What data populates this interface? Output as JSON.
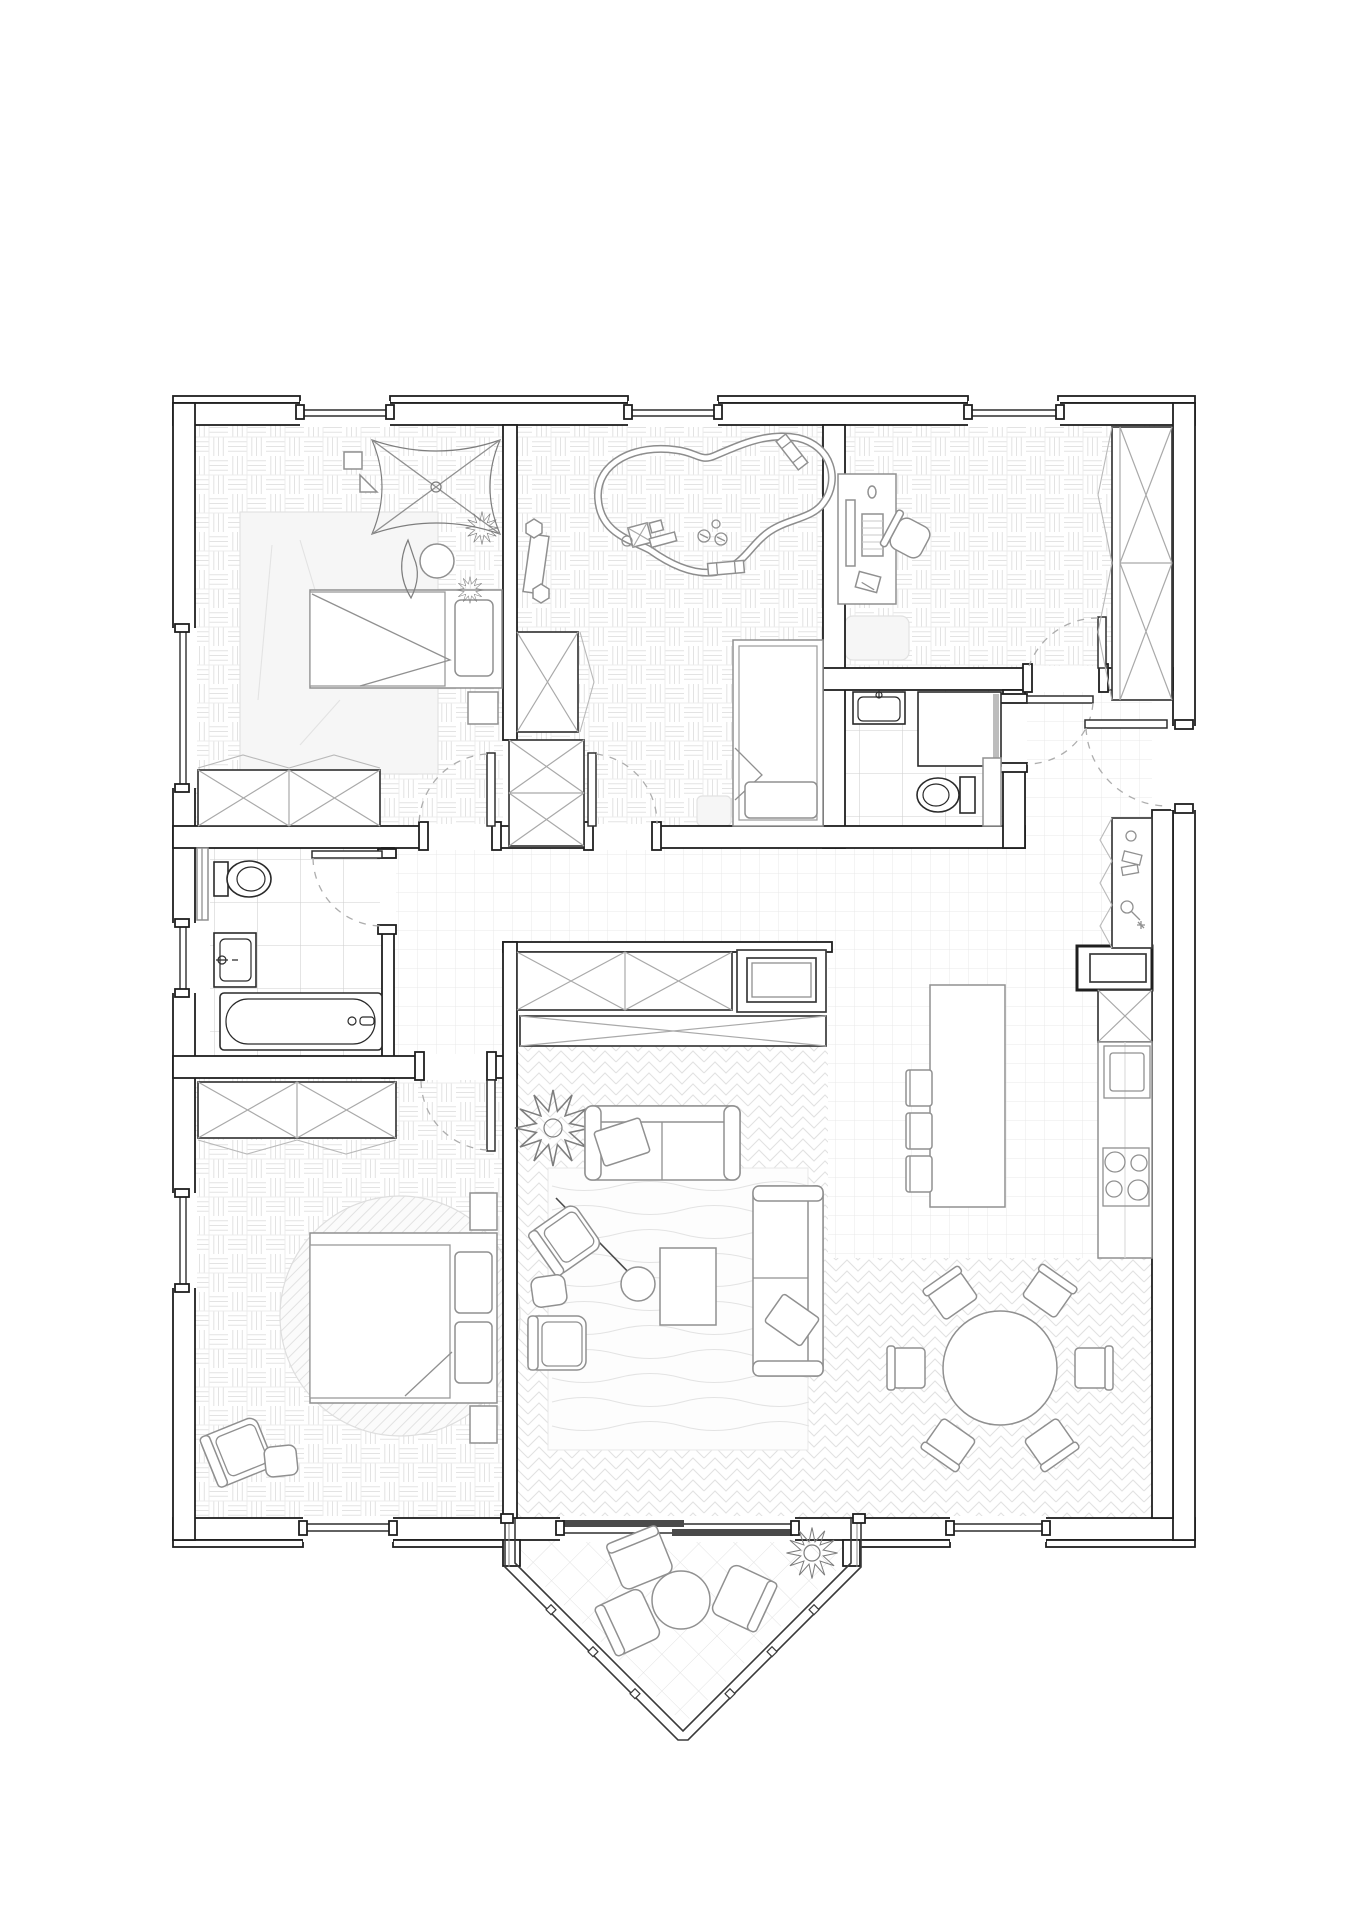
{
  "document": {
    "title": "Apartment floor plan — top view architectural drawing",
    "description": "Black and grey line drawing of a three-bedroom apartment with office, two bathrooms, open living-kitchen-dining space and a pointed balcony with outdoor seating.",
    "background_color": "#ffffff",
    "wall_line_color": "#1f1f1f",
    "furniture_line_color": "#909090",
    "floor_pattern_color": "#e3e3e3",
    "door_arc_style": "dashed grey quarter circles"
  },
  "rooms": [
    {
      "id": "bedroom-1",
      "location": "top-left",
      "floor": "basketweave parquet",
      "furniture": [
        "large light area rug",
        "single bed with pillow and folded duvet",
        "hanging play mobile with four fabric sails",
        "small wall frame",
        "triangle pennant",
        "round floor cushion",
        "leafy plants",
        "two-module X-front dresser",
        "bedside bench"
      ]
    },
    {
      "id": "kids-room",
      "location": "top-middle",
      "floor": "basketweave parquet",
      "furniture": [
        "toy train track loop with train, wheels and two bridges",
        "angled play bench with two hexagonal stools",
        "tall X-front wardrobe",
        "single bed with pillow",
        "small rug"
      ]
    },
    {
      "id": "office",
      "location": "top-right",
      "floor": "basketweave parquet",
      "furniture": [
        "desk with monitor, keyboard, mouse and notepad",
        "swivel office chair",
        "small rug",
        "full-height X-front wardrobe with swing marks"
      ]
    },
    {
      "id": "bathroom-small",
      "location": "middle-right",
      "floor": "large tile grid",
      "fixtures": [
        "washbasin with tap",
        "shower cabin with glass panel",
        "toilet with cistern",
        "tall slim cabinet"
      ]
    },
    {
      "id": "bathroom-main",
      "location": "middle-left",
      "floor": "large tile grid",
      "fixtures": [
        "wall radiator",
        "toilet with cistern",
        "washbasin with tap",
        "bathtub with faucet"
      ]
    },
    {
      "id": "hallway",
      "location": "center",
      "floor": "fine square tile grid",
      "furniture": []
    },
    {
      "id": "entry",
      "location": "right",
      "floor": "fine square tile grid",
      "furniture": [
        "entry door",
        "three-door wardrobe with swing marks",
        "mirror dot, shoe boxes and key hook glyphs"
      ]
    },
    {
      "id": "bedroom-2",
      "location": "bottom-left",
      "floor": "basketweave parquet",
      "furniture": [
        "two-module X-front closet",
        "double bed with two pillows and folded duvet",
        "two nightstands",
        "round hatched rug",
        "armchair with ottoman"
      ]
    },
    {
      "id": "living-room",
      "location": "bottom-center",
      "floor": "herringbone parquet",
      "furniture": [
        "X-front sideboard",
        "TV unit with television",
        "long low X-front console",
        "spiky potted plant",
        "three-seat sofa with cushion",
        "chaise sofa with cushion",
        "rectangular coffee table",
        "arc floor lamp",
        "two armchairs",
        "ottoman",
        "large wavy-striped rug"
      ]
    },
    {
      "id": "kitchen",
      "location": "right",
      "floor": "fine square tile grid",
      "furniture": [
        "refrigerator box",
        "tall X-front cabinet",
        "counter with sink",
        "cooktop with four burners",
        "kitchen island",
        "three bar stools"
      ]
    },
    {
      "id": "dining",
      "location": "bottom-right",
      "floor": "herringbone parquet",
      "furniture": [
        "round dining table",
        "six chairs"
      ]
    },
    {
      "id": "balcony",
      "location": "bottom, pointed pentagon",
      "floor": "diagonal tile grid",
      "furniture": [
        "railing with posts",
        "round outdoor table",
        "three outdoor armchairs",
        "spiky plant"
      ]
    }
  ],
  "openings": {
    "windows_top": 3,
    "windows_left": 3,
    "windows_bottom": 3,
    "sliding_door": "wide two-panel slider from living room to balcony",
    "entry_door": "right wall with dashed swing arc",
    "interior_doors": [
      "bedroom-1",
      "kids-room",
      "office",
      "bathroom-small",
      "bathroom-main",
      "bedroom-2"
    ]
  },
  "counts": {
    "dining_chairs": 6,
    "kitchen_stools": 3,
    "balcony_chairs": 3,
    "cooktop_burners": 4
  }
}
